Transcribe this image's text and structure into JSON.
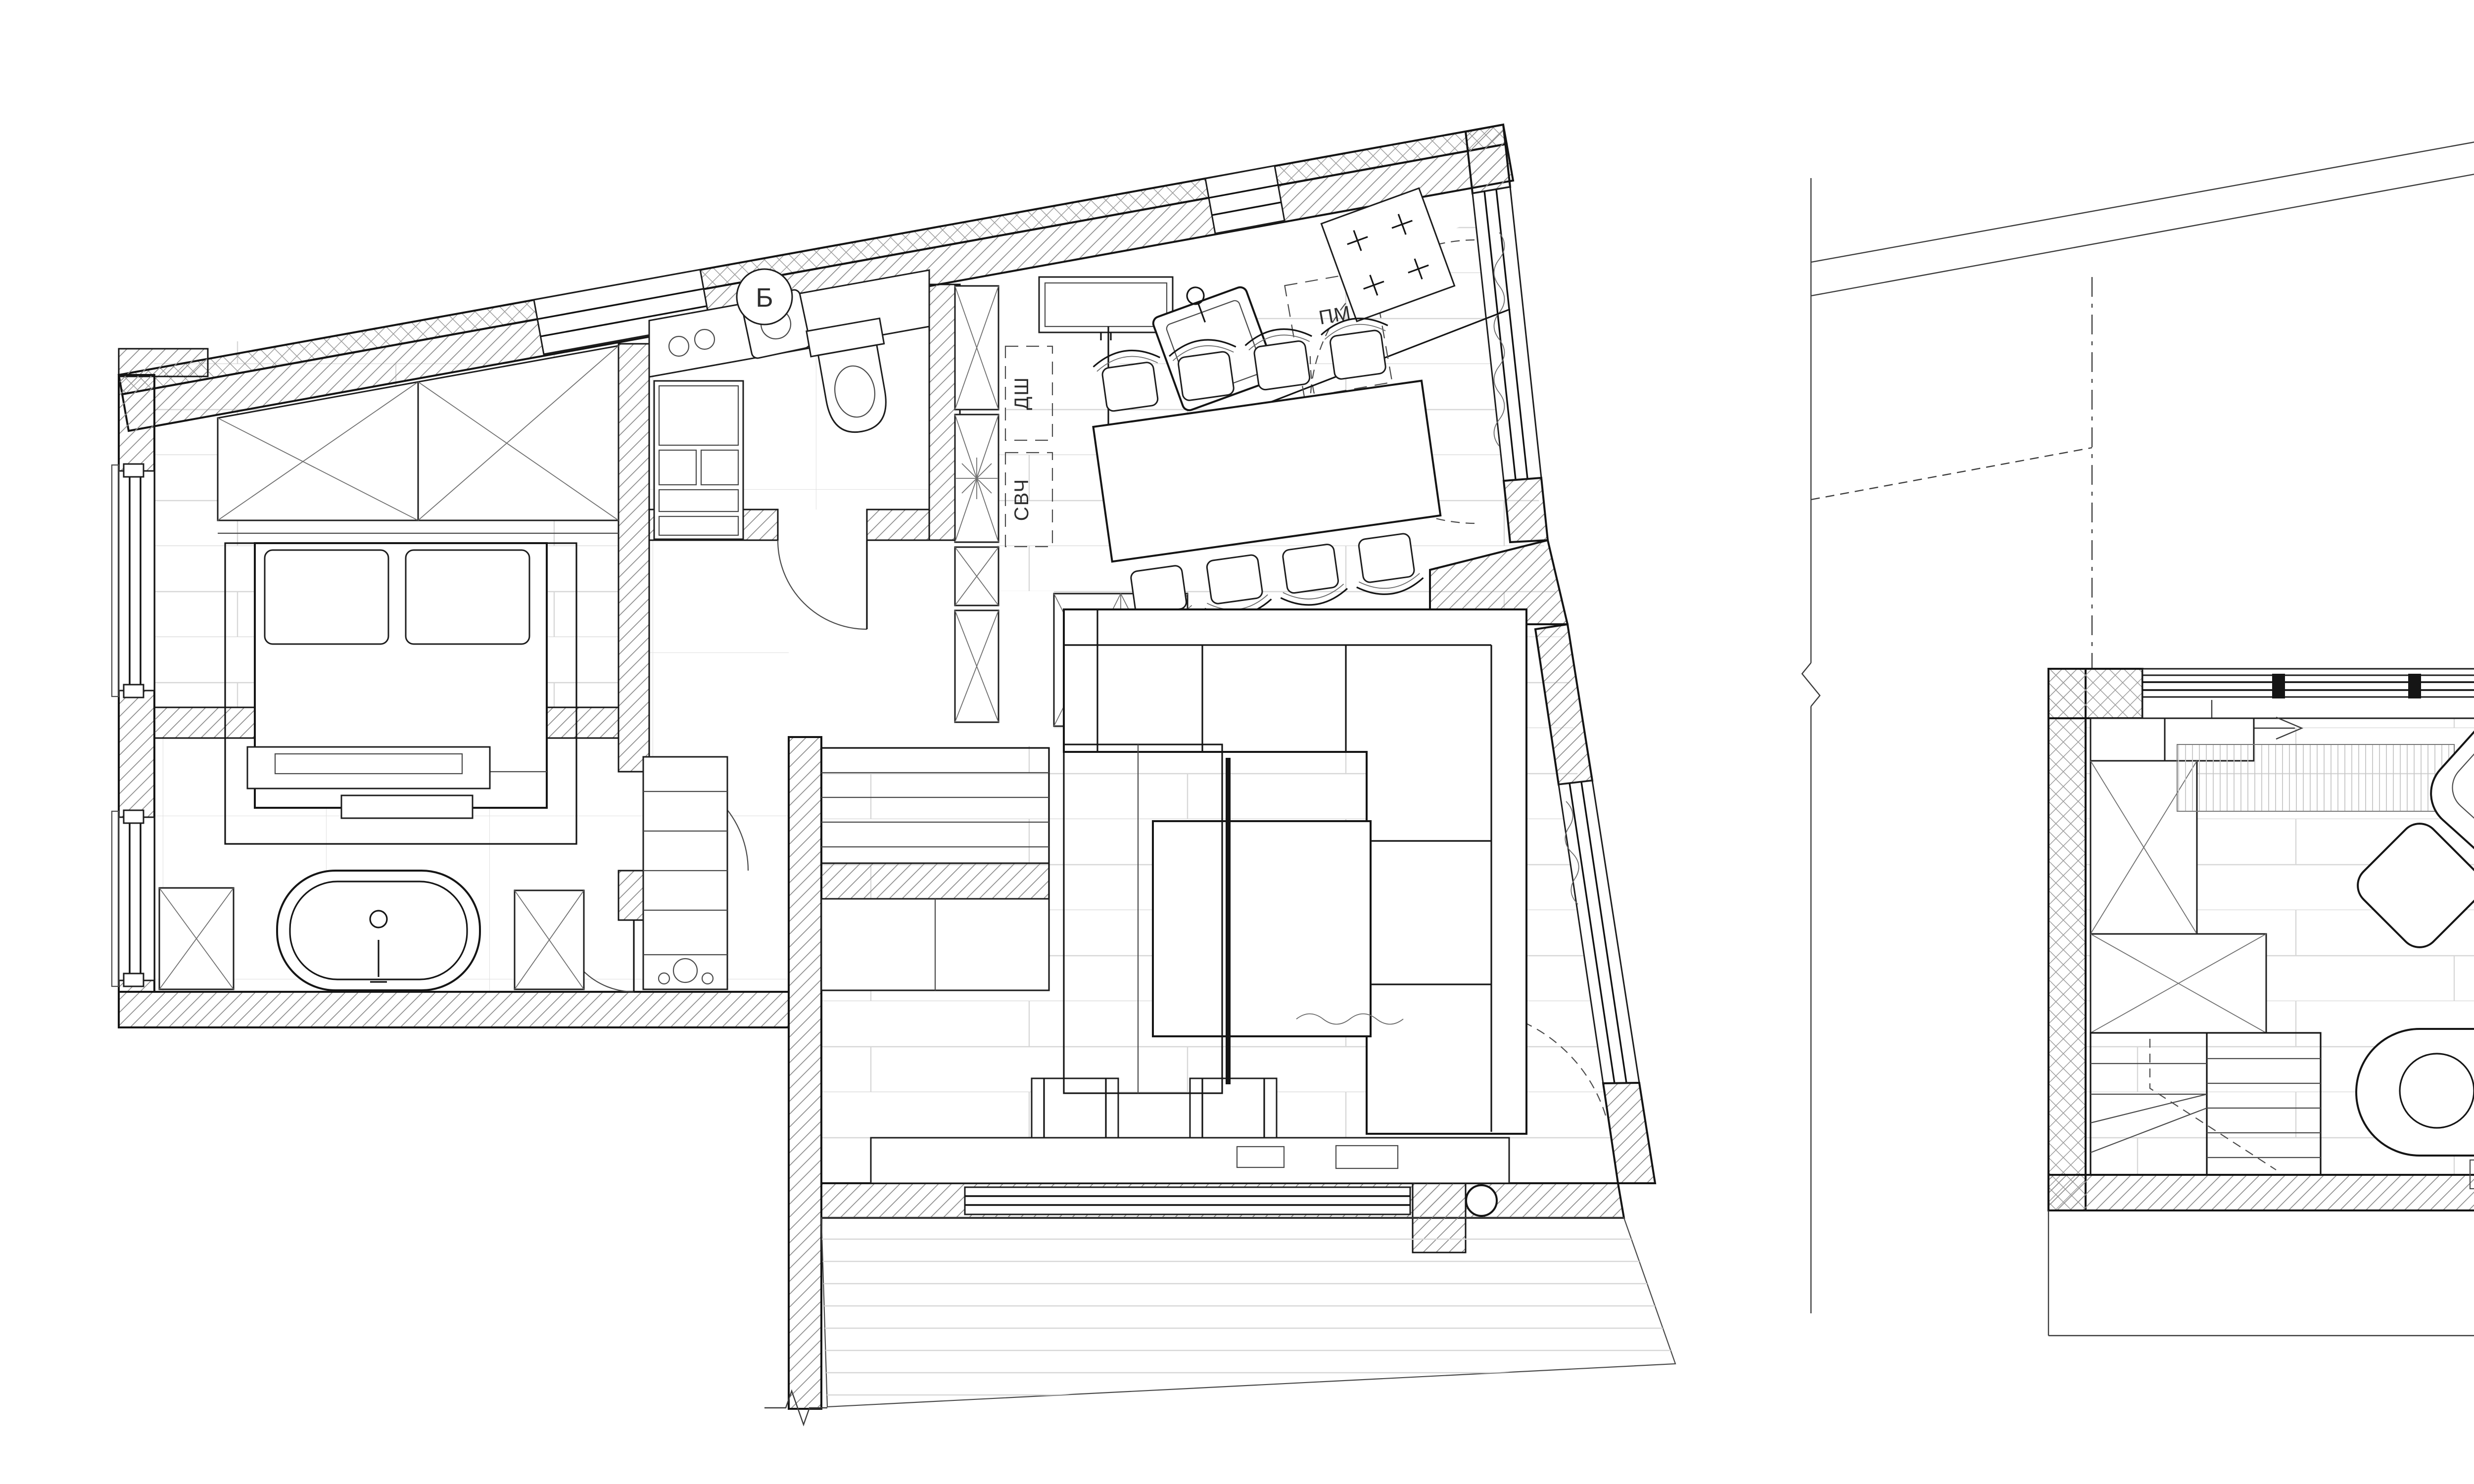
{
  "sheet": {
    "type": "architectural floor plan drawing",
    "paper_color": "#ffffff",
    "line_color": "#151515",
    "hatch_color": "#8f8f8f",
    "floor_line_color": "#d7d7d7"
  },
  "plans": {
    "main_level": {
      "name": "main level apartment plan",
      "rooms": [
        "bedroom",
        "bathroom",
        "laundry-wc",
        "hallway",
        "kitchen",
        "dining",
        "living room",
        "terrace"
      ],
      "labels": {
        "dishwasher": "ПМ",
        "oven": "ДШ",
        "microwave": "СВЧ",
        "boiler": "Б"
      }
    },
    "upper_level": {
      "name": "upper level study plan",
      "rooms": [
        "stairs",
        "study"
      ],
      "labels": {}
    }
  }
}
